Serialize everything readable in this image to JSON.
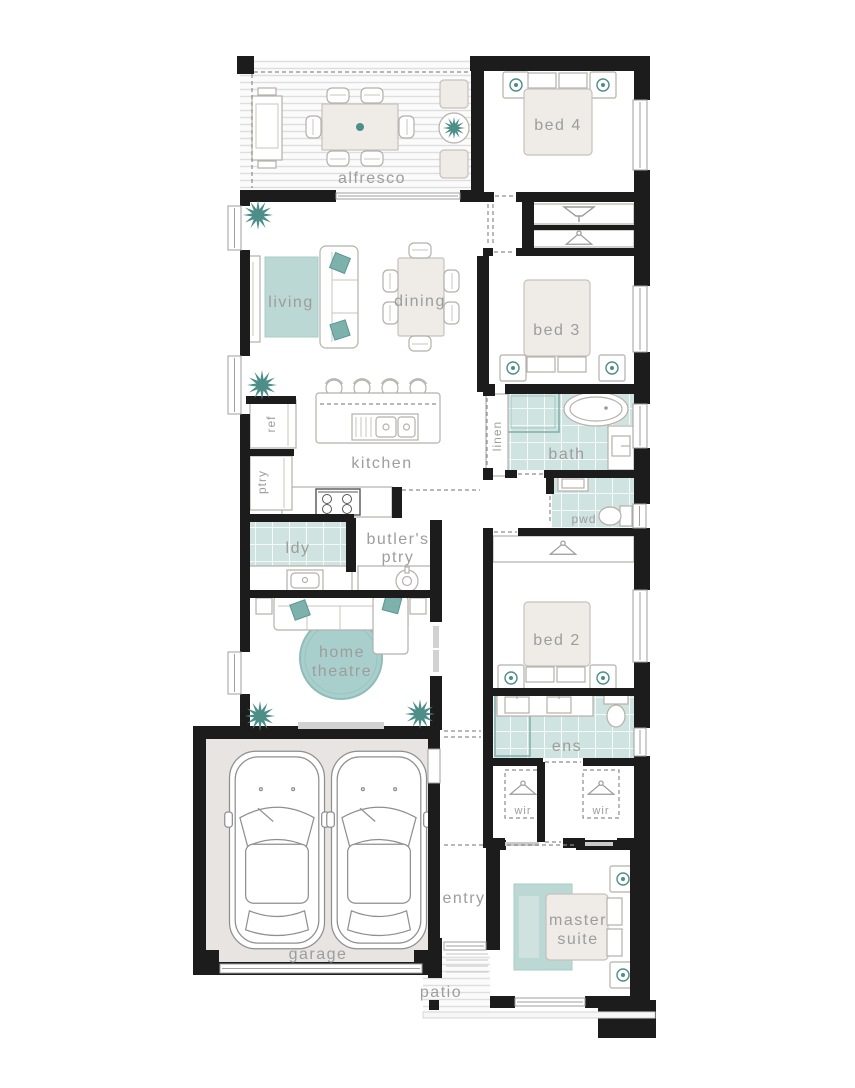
{
  "page": {
    "title": "single storey home floor plan"
  },
  "colors": {
    "wall": "#1c1c1c",
    "label": "#9d9d9d",
    "accent_teal": "#4d8e89",
    "tile_teal": "#cfe3e1",
    "rug_teal": "#bcd8d5",
    "theatre_rug": "#a9cfcc",
    "furniture_fill": "#efebe7",
    "furniture_stroke": "#b5b0ab",
    "garage_floor": "#e7e4e1",
    "outline_gray": "#9a9a9a"
  },
  "rooms": {
    "alfresco": {
      "label": "alfresco"
    },
    "bed4": {
      "label": "bed 4"
    },
    "living": {
      "label": "living"
    },
    "dining": {
      "label": "dining"
    },
    "bed3": {
      "label": "bed 3"
    },
    "kitchen": {
      "label": "kitchen"
    },
    "ref": {
      "label": "ref"
    },
    "ptry": {
      "label": "ptry"
    },
    "linen": {
      "label": "linen"
    },
    "bath": {
      "label": "bath"
    },
    "pwd": {
      "label": "pwd"
    },
    "ldy": {
      "label": "ldy"
    },
    "butlers_ptry": {
      "line1": "butler's",
      "line2": "ptry"
    },
    "bed2": {
      "label": "bed 2"
    },
    "home_theatre": {
      "line1": "home",
      "line2": "theatre"
    },
    "ens": {
      "label": "ens"
    },
    "wir_left": {
      "label": "wir"
    },
    "wir_right": {
      "label": "wir"
    },
    "entry": {
      "label": "entry"
    },
    "master_suite": {
      "line1": "master",
      "line2": "suite"
    },
    "garage": {
      "label": "garage"
    },
    "patio": {
      "label": "patio"
    }
  },
  "icons": {
    "plant": "teal starburst indoor plant",
    "hanger": "clothes hanger",
    "lamp": "bedside table with lamp",
    "car": "car top view",
    "bath_tub": "freestanding bath tub",
    "toilet": "toilet",
    "basin": "basin with tap",
    "cooktop": "gas cooktop",
    "sink": "kitchen sink",
    "stool": "island bench stool",
    "bbq": "bbq grill"
  }
}
